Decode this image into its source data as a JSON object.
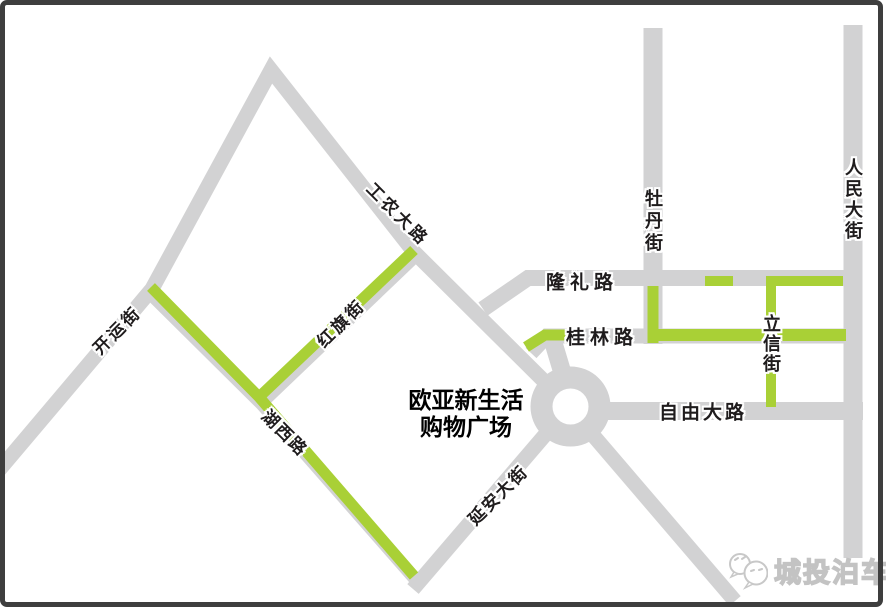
{
  "map_title_context": "street map of Ouya New Life Shopping Plaza area",
  "colors": {
    "road_gray": "#d2d2d3",
    "route_highlight_green": "#a9d036",
    "frame_border": "#3e3e3e",
    "label_black": "#1f1c1d",
    "watermark_gray": "#c3c3c3",
    "background": "#ffffff"
  },
  "roads": [
    {
      "name": "工农大路",
      "highlighted": false
    },
    {
      "name": "开运街",
      "highlighted": false
    },
    {
      "name": "红旗街",
      "highlighted": true
    },
    {
      "name": "湖西路",
      "highlighted": true
    },
    {
      "name": "延安大街",
      "highlighted": false
    },
    {
      "name": "隆礼路",
      "highlighted": "partial"
    },
    {
      "name": "桂林路",
      "highlighted": "partial"
    },
    {
      "name": "自由大路",
      "highlighted": false
    },
    {
      "name": "牡丹街",
      "highlighted": "partial"
    },
    {
      "name": "人民大街",
      "highlighted": false
    },
    {
      "name": "立信街",
      "highlighted": true
    }
  ],
  "poi": {
    "line1": "欧亚新生活",
    "line2": "购物广场"
  },
  "features": {
    "roundabout": "traffic circle at junction of 延安大街 / 自由大路 / 工农大路"
  },
  "watermark": {
    "brand": "城投泊车",
    "icon": "speech-bubbles-logo-icon"
  }
}
